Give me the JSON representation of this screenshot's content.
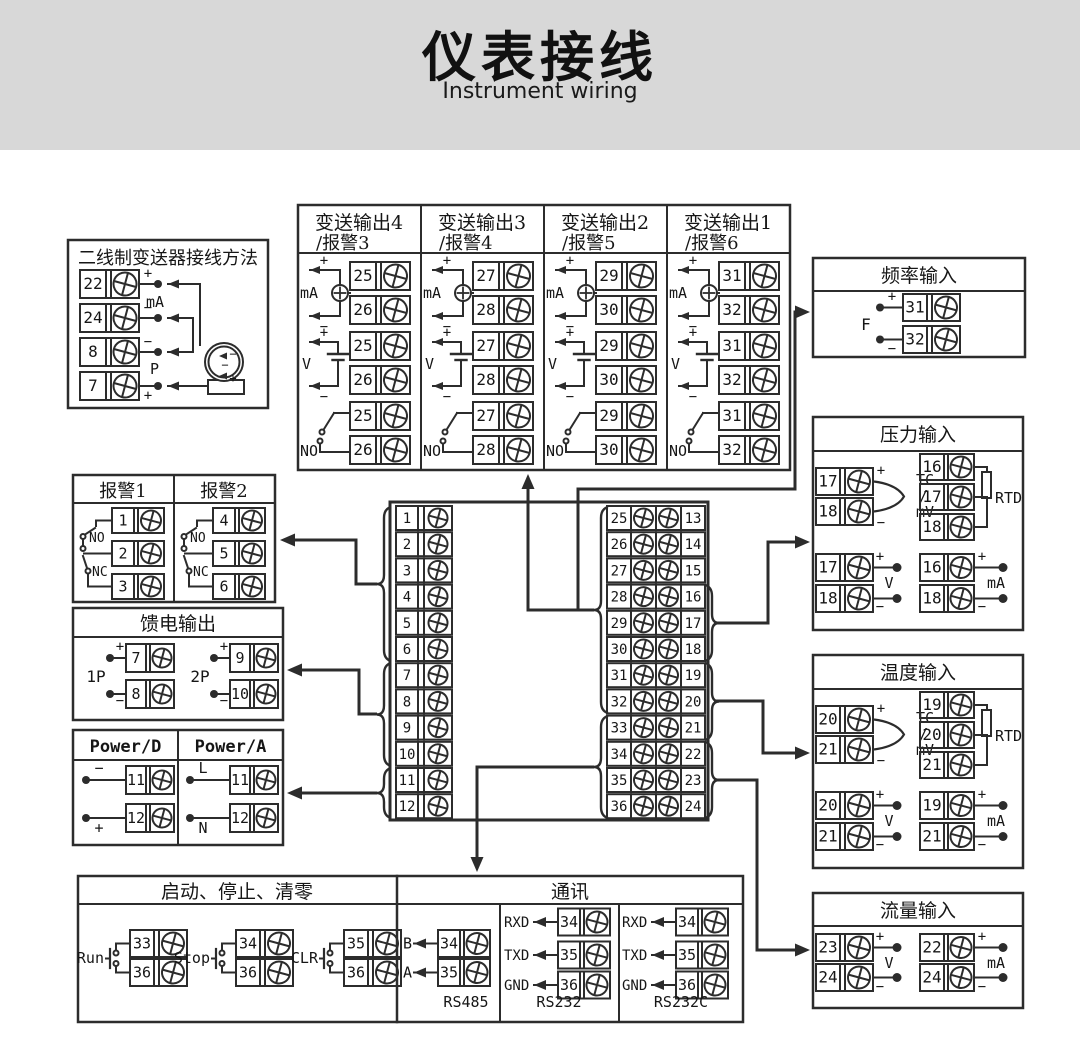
{
  "header": {
    "title": "仪表接线",
    "subtitle": "Instrument wiring"
  },
  "signs": {
    "plus": "+",
    "minus": "−"
  },
  "two_wire": {
    "title": "二线制变送器接线方法",
    "rows": [
      {
        "num": "22",
        "sign": "+"
      },
      {
        "num": "24",
        "sign": "−"
      },
      {
        "num": "8",
        "sign": "−"
      },
      {
        "num": "7",
        "sign": "+"
      }
    ],
    "labels": {
      "ma": "mA",
      "p": "P"
    },
    "transmitter_signs": [
      "−",
      "−",
      "+"
    ]
  },
  "transmit": {
    "labels": {
      "ma": "mA",
      "v": "V",
      "no": "NO"
    },
    "columns": [
      {
        "title1": "变送输出4",
        "title2": "/报警3",
        "top": "25",
        "bot": "26"
      },
      {
        "title1": "变送输出3",
        "title2": "/报警4",
        "top": "27",
        "bot": "28"
      },
      {
        "title1": "变送输出2",
        "title2": "/报警5",
        "top": "29",
        "bot": "30"
      },
      {
        "title1": "变送输出1",
        "title2": "/报警6",
        "top": "31",
        "bot": "32"
      }
    ]
  },
  "freq": {
    "title": "频率输入",
    "label": "F",
    "top": "31",
    "bot": "32"
  },
  "pressure": {
    "title": "压力输入",
    "tcmv": {
      "top": "17",
      "bot": "18",
      "lines": [
        "TC",
        "/",
        "mV"
      ]
    },
    "rtd": {
      "nums": [
        "16",
        "17",
        "18"
      ],
      "label": "RTD"
    },
    "v": {
      "top": "17",
      "bot": "18",
      "label": "V"
    },
    "ma": {
      "top": "16",
      "bot": "18",
      "label": "mA"
    }
  },
  "temp": {
    "title": "温度输入",
    "tcmv": {
      "top": "20",
      "bot": "21",
      "lines": [
        "TC",
        "/",
        "mV"
      ]
    },
    "rtd": {
      "nums": [
        "19",
        "20",
        "21"
      ],
      "label": "RTD"
    },
    "v": {
      "top": "20",
      "bot": "21",
      "label": "V"
    },
    "ma": {
      "top": "19",
      "bot": "21",
      "label": "mA"
    }
  },
  "flow": {
    "title": "流量输入",
    "v": {
      "top": "23",
      "bot": "24",
      "label": "V"
    },
    "ma": {
      "top": "22",
      "bot": "24",
      "label": "mA"
    }
  },
  "alarm": {
    "columns": [
      {
        "title": "报警1",
        "nums": [
          "1",
          "2",
          "3"
        ],
        "no": "NO",
        "nc": "NC"
      },
      {
        "title": "报警2",
        "nums": [
          "4",
          "5",
          "6"
        ],
        "no": "NO",
        "nc": "NC"
      }
    ]
  },
  "feed": {
    "title": "馈电输出",
    "groups": [
      {
        "label": "1P",
        "top": "7",
        "bot": "8"
      },
      {
        "label": "2P",
        "top": "9",
        "bot": "10"
      }
    ]
  },
  "power": {
    "columns": [
      {
        "title": "Power/D",
        "top_sign": "−",
        "bot_sign": "+",
        "top": "11",
        "bot": "12"
      },
      {
        "title": "Power/A",
        "top_sign": "L",
        "bot_sign": "N",
        "top": "11",
        "bot": "12"
      }
    ]
  },
  "runstop": {
    "title": "启动、停止、清零",
    "groups": [
      {
        "label": "Run",
        "top": "33",
        "bot": "36"
      },
      {
        "label": "Stop",
        "top": "34",
        "bot": "36"
      },
      {
        "label": "CLR",
        "top": "35",
        "bot": "36"
      }
    ]
  },
  "comm": {
    "title": "通讯",
    "sections": [
      {
        "name": "RS485",
        "rows": [
          {
            "label": "B",
            "num": "34"
          },
          {
            "label": "A",
            "num": "35"
          }
        ]
      },
      {
        "name": "RS232",
        "rows": [
          {
            "label": "RXD",
            "num": "34"
          },
          {
            "label": "TXD",
            "num": "35"
          },
          {
            "label": "GND",
            "num": "36"
          }
        ]
      },
      {
        "name": "RS232C",
        "rows": [
          {
            "label": "RXD",
            "num": "34"
          },
          {
            "label": "TXD",
            "num": "35"
          },
          {
            "label": "GND",
            "num": "36"
          }
        ]
      }
    ]
  },
  "main": {
    "left": [
      "1",
      "2",
      "3",
      "4",
      "5",
      "6",
      "7",
      "8",
      "9",
      "10",
      "11",
      "12"
    ],
    "right": [
      [
        "25",
        "13"
      ],
      [
        "26",
        "14"
      ],
      [
        "27",
        "15"
      ],
      [
        "28",
        "16"
      ],
      [
        "29",
        "17"
      ],
      [
        "30",
        "18"
      ],
      [
        "31",
        "19"
      ],
      [
        "32",
        "20"
      ],
      [
        "33",
        "21"
      ],
      [
        "34",
        "22"
      ],
      [
        "35",
        "23"
      ],
      [
        "36",
        "24"
      ]
    ]
  }
}
